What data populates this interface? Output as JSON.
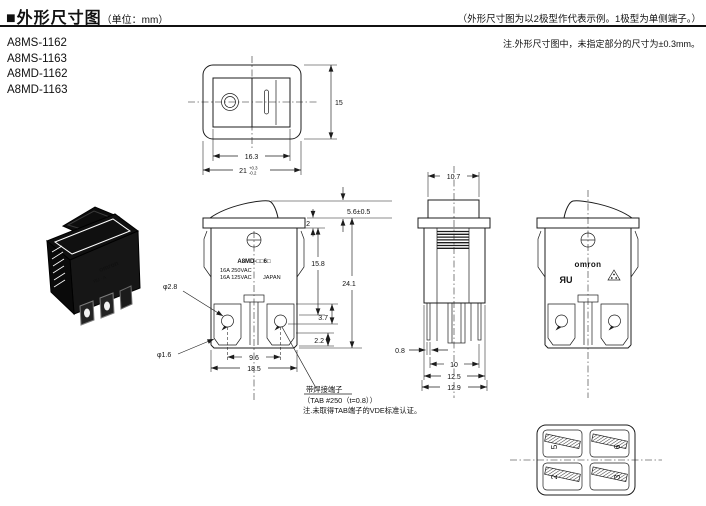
{
  "header": {
    "title": "■外形尺寸图",
    "unit": "（单位：mm）",
    "representative_note": "（外形尺寸图为以2极型作代表示例。1极型为单侧端子。）",
    "tolerance_note": "注.外形尺寸图中，未指定部分的尺寸为±0.3mm。"
  },
  "models": [
    "A8MS-1162",
    "A8MS-1163",
    "A8MD-1162",
    "A8MD-1163"
  ],
  "top_view": {
    "inner_width": "16.3",
    "outer_width": "21",
    "outer_width_tol_plus": "+0.3",
    "outer_width_tol_minus": "-0.2",
    "height": "15"
  },
  "front_view": {
    "marking_model": "A8MD-□□6□",
    "marking_rating1": "16A 250VAC",
    "marking_rating2": "16A 125VAC",
    "marking_origin": "JAPAN",
    "dim_rocker_height": "5.6±0.5",
    "dim_flange_thickness": "2",
    "dim_body_height": "15.8",
    "dim_total_height": "24.1",
    "dim_hole_large": "φ2.8",
    "dim_hole_small": "φ1.6",
    "dim_terminal_depth": "3.7",
    "dim_terminal_edge": "2.2",
    "dim_terminal_pitch": "9.6",
    "dim_body_width": "18.5",
    "solder_note1": "带焊接端子",
    "solder_note2": "（TAB #250（t=0.8））",
    "solder_note3": "注.未取得TAB端子的VDE标准认证。"
  },
  "side_view": {
    "dim_rocker_width": "10.7",
    "dim_terminal_thickness": "0.8",
    "dim_terminal_span": "10",
    "dim_depth_body": "12.5",
    "dim_depth_overall": "12.9"
  },
  "back_view": {
    "brand": "omron",
    "ul_mark": "ЯU"
  },
  "bottom_view": {
    "terminals": [
      "5",
      "6",
      "2",
      "3"
    ]
  }
}
